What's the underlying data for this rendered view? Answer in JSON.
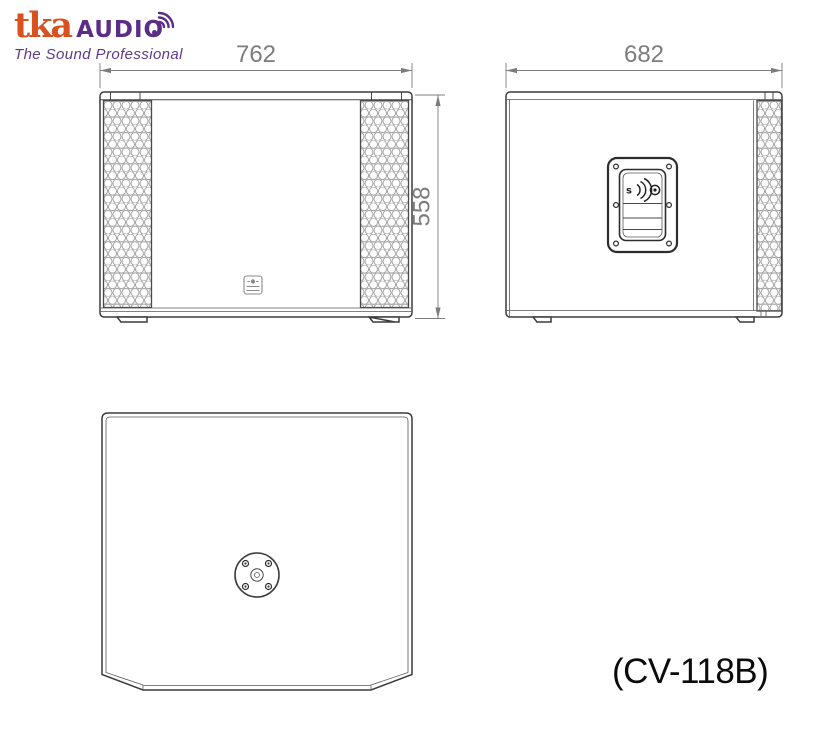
{
  "brand": {
    "wordmark_primary": "tka",
    "wordmark_secondary": "AUDIO",
    "tagline": "The Sound Professional",
    "color_primary": "#D8511F",
    "color_secondary": "#5B2D87"
  },
  "drawing": {
    "front_view": {
      "width_label": "762",
      "height_label": "558"
    },
    "side_view": {
      "depth_label": "682"
    },
    "handle_mark": "s",
    "outline_color": "#3C3C3C",
    "dimension_color": "#7C7C7C",
    "grille_color": "#9B9B9B"
  },
  "model_label": "(CV-118B)"
}
